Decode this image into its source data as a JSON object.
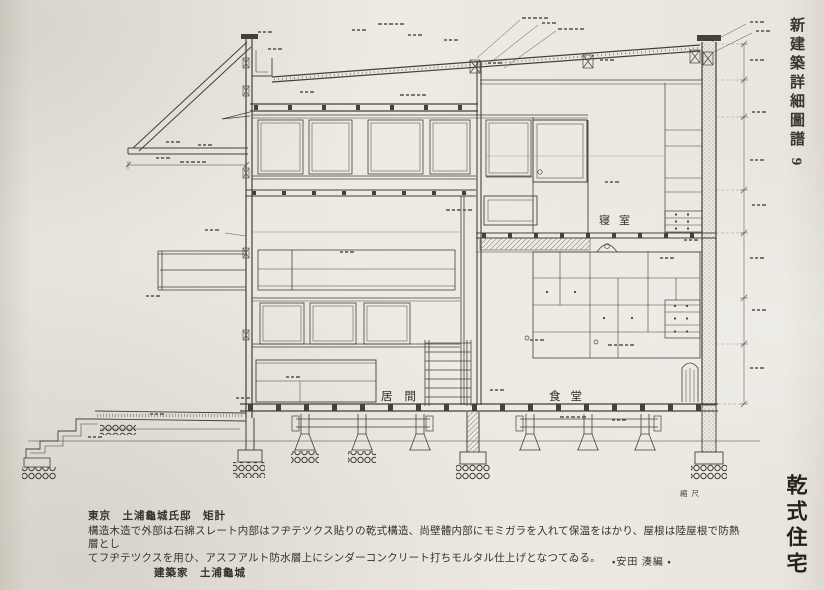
{
  "page": {
    "journal_title": "新建築詳細圖譜 9",
    "plate_title": "乾式住宅"
  },
  "caption": {
    "location_line": "東京　土浦龜城氏邸　矩計",
    "body_line1": "構造木造で外部は石綿スレート内部はフヂテツクス貼りの乾式構造、尚壁體内部にモミガラを入れて保温をはかり、屋根は陸屋根で防熱層とし",
    "body_line2": "てフヂテツクスを用ひ、アスフアルト防水層上にシンダーコンクリート打ちモルタル仕上げとなつてゐる。",
    "architect_line": "建築家　土浦龜城",
    "editor_credit": "・安田 湊編 ・"
  },
  "drawing": {
    "room_labels": {
      "living": "居間",
      "dining": "食堂",
      "bedroom": "寝室"
    },
    "scale_note": "縮尺"
  }
}
